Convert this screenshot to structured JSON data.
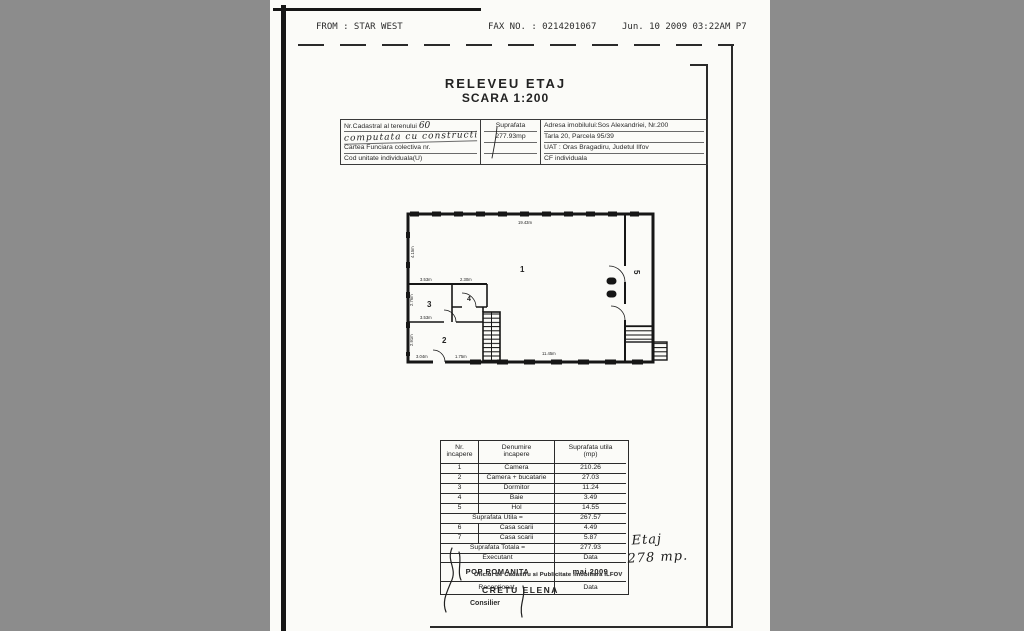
{
  "fax_header": {
    "from": "FROM : STAR WEST",
    "fax_no": "FAX NO. : 0214201067",
    "datetime": "Jun. 10 2009 03:22AM P7"
  },
  "title": {
    "line1": "RELEVEU ETAJ",
    "line2": "SCARA 1:200"
  },
  "info_table": {
    "cadastral_label": "Nr.Cadastral al terenului",
    "cadastral_handwritten_nr": "60",
    "cadastral_handwritten_note": "computata cu constructia",
    "land_book_label": "Cartea Funciara colectiva nr.",
    "unit_code_label": "Cod unitate individuala(U)",
    "area_label": "Suprafata",
    "area_value": "277.93mp",
    "address_line1": "Adresa imobilului:Sos Alexandriei, Nr.200",
    "address_line2": "Tarla 20, Parcela 95/39",
    "address_line3": "UAT : Oras Bragadiru, Judetul Ilfov",
    "address_line4": "CF individuala"
  },
  "floor_plan": {
    "labels": [
      "1",
      "2",
      "3",
      "4",
      "5"
    ],
    "dims": {
      "top": "19.43m",
      "bottom": "11.45m",
      "left": "4.15m",
      "room3_top": "3.53m",
      "room3_left": "2.76m",
      "room2_top": "3.53m",
      "room2_left": "2.91m",
      "room4_top": "2.30m",
      "bottom_a": "3.04m",
      "bottom_b": "1.75m"
    }
  },
  "rooms_table": {
    "headers": {
      "c1a": "Nr.",
      "c1b": "incapere",
      "c2a": "Denumire",
      "c2b": "incapere",
      "c3a": "Suprafata utila",
      "c3b": "(mp)"
    },
    "rows": [
      {
        "nr": "1",
        "name": "Camera",
        "area": "210.26"
      },
      {
        "nr": "2",
        "name": "Camera + bucatarie",
        "area": "27.03"
      },
      {
        "nr": "3",
        "name": "Dormitor",
        "area": "11.24"
      },
      {
        "nr": "4",
        "name": "Baie",
        "area": "3.49"
      },
      {
        "nr": "5",
        "name": "Hol",
        "area": "14.55"
      }
    ],
    "subtotal_label": "Suprafata Utila =",
    "subtotal_value": "267.57",
    "extra_rows": [
      {
        "nr": "6",
        "name": "Casa scarii",
        "area": "4.49"
      },
      {
        "nr": "7",
        "name": "Casa scarii",
        "area": "5.87"
      }
    ],
    "total_label": "Suprafata Totala =",
    "total_value": "277.93",
    "executant_label": "Executant",
    "data_label": "Data",
    "executant_name": "POP ROMANITA",
    "executant_date": "mai 2009",
    "received_label": "Receptionat,",
    "received_data_label": "Data"
  },
  "stamp": {
    "office": "Oficiul de Cadastru si Publicitate Imobiliara ILFOV",
    "name": "CRETU ELENA",
    "role": "Consilier"
  },
  "handwritten_note": {
    "line1": "Etaj",
    "line2": "278 mp."
  }
}
